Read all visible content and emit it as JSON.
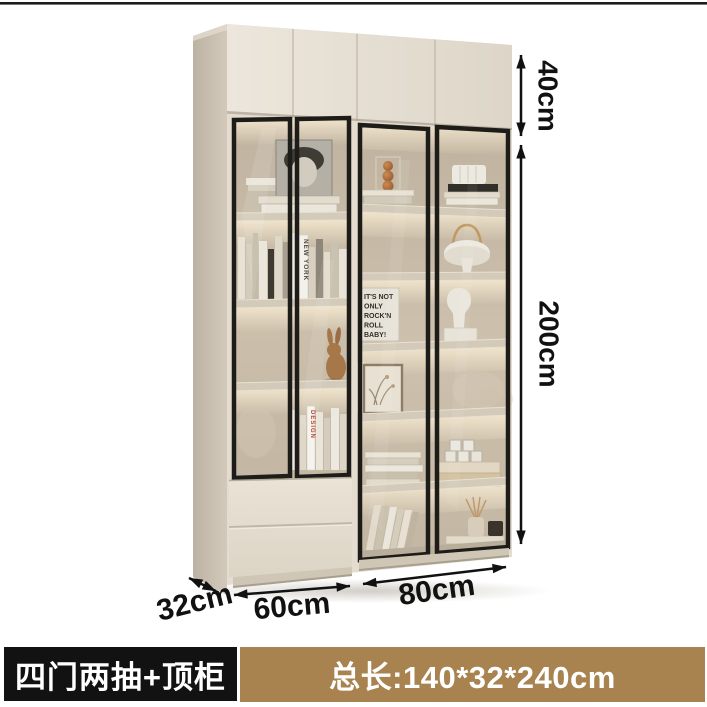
{
  "page": {
    "type": "product-detail-image",
    "background": "#ffffff"
  },
  "dimensions": {
    "top_cabinet_height": "40cm",
    "cabinet_height": "200cm",
    "depth": "32cm",
    "left_section_width": "60cm",
    "right_section_width": "80cm"
  },
  "banner": {
    "variant_label": "四门两抽+顶柜",
    "size_label": "总长:140*32*240cm",
    "variant_bg": "#121212",
    "size_bg": "#a9834f",
    "text_color": "#ffffff"
  },
  "decor_text": {
    "poster_line1": "IT'S NOT",
    "poster_line2": "ONLY",
    "poster_line3": "ROCK'N",
    "poster_line4": "ROLL",
    "poster_line5": "BABY!",
    "book_spine_a": "NEW YORK",
    "book_spine_b": "DESIGN"
  },
  "cabinet": {
    "style": "cream display bookcase, black-framed glass doors, warm LED shelf lighting, top cabinet, two drawers",
    "colors": {
      "body": "#e7e1d6",
      "side": "#c9bfb1",
      "frame": "#1e1c19",
      "interior_wall": "#cdc1af",
      "glow": "#f9ecd4",
      "drawer": "#e6dfd2",
      "plinth": "#cfc6b6"
    },
    "left_section_items": [
      "portrait art print",
      "stacked books",
      "row of standing books",
      "wood rabbit figurine",
      "design books",
      "two drawers"
    ],
    "right_section_items": [
      "amber glass ornament",
      "stacked magazines",
      "ribbed storage jar on books",
      "portable mushroom lamp",
      "typography poster",
      "torso sculpture",
      "framed botanical print",
      "letter dice on books",
      "stacked flat books",
      "leaning books",
      "reed diffuser and canister"
    ]
  }
}
